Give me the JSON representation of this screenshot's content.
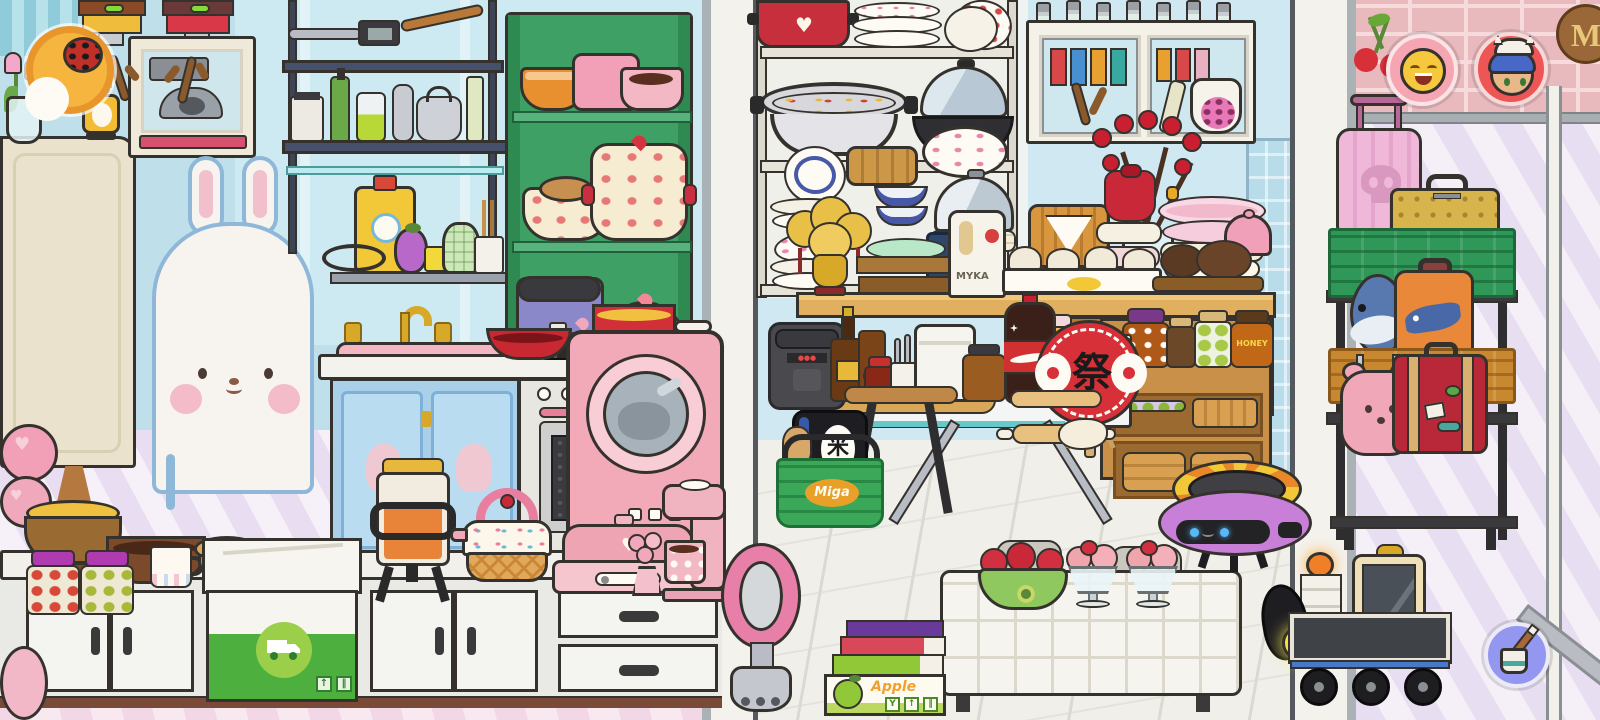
{
  "hud": {
    "player_button": {
      "icon": "player-avatar"
    },
    "character_button_1": {
      "icon": "smiley-face"
    },
    "character_button_2": {
      "icon": "blue-hair-kid"
    },
    "decorate_button": {
      "icon": "paint-bucket"
    }
  },
  "labels": {
    "festival_fan_kanji": "祭",
    "rice_bag_kanji": "米",
    "basket_brand": "Miga",
    "flour_bag_text": "MYKA",
    "honey_jar_text": "HONEY",
    "apple_box_text": "Apple",
    "wood_sign_letter": "M",
    "apple_box_icons": {
      "glass": "Y",
      "up": "↑",
      "pause": "‖"
    },
    "delivery_box_icons": {
      "up": "↑",
      "pause": "‖"
    }
  },
  "palette": {
    "wall_blue": "#c4e2ec",
    "stripe_lavender": "#e7def1",
    "brick_pink": "#e9babd",
    "outline": "#35322e",
    "counter_white": "#f2f0ea",
    "cabinet_blue": "#a9d0e8",
    "shelf_green": "#3fa065",
    "dryer_pink": "#f2a9b8",
    "crate_green": "#2f9858",
    "accent_red": "#d23440",
    "hud_pink": "#f6a6b2",
    "hud_red": "#ee5656",
    "hud_purple": "#9397ef",
    "hud_orange": "#f2a33c"
  }
}
